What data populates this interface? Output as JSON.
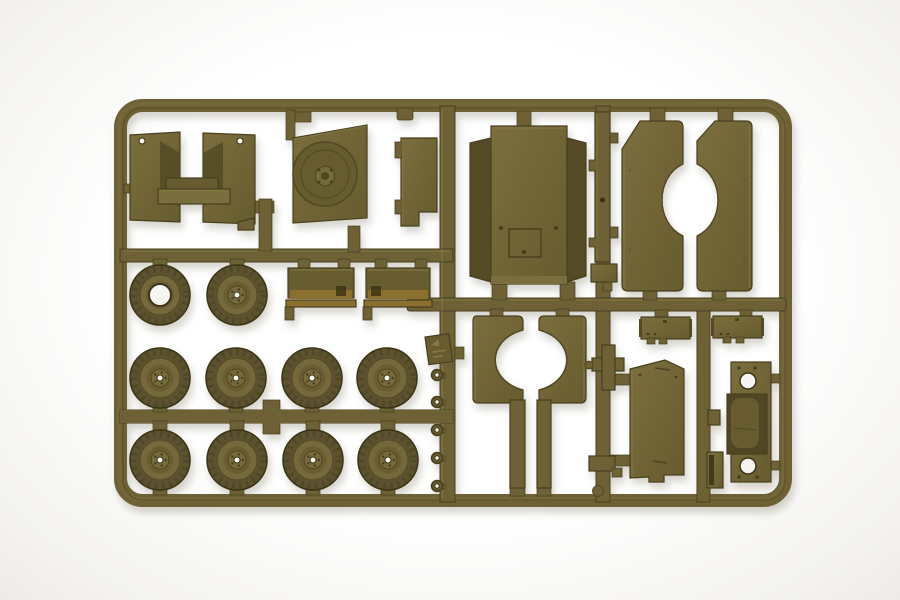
{
  "meta": {
    "type": "photograph",
    "subject": "olive drab injection-molded plastic model kit sprue (parts tree) for a military vehicle kit",
    "background": "plain white studio background with soft shadow"
  },
  "colors": {
    "background": "#f4f3f0",
    "background_center": "#ffffff",
    "plastic_base": "#6d6135",
    "plastic_mid": "#675c2f",
    "plastic_light": "#7b6e3e",
    "plastic_lighter": "#8d7f4a",
    "plastic_dark": "#544a25",
    "plastic_edge": "#473f1e",
    "plastic_deep": "#3a3314",
    "plastic_warm": "#8a6f2e",
    "plastic_recess": "#4f4723",
    "tire": "#5c5230",
    "sidewall": "#75683a",
    "hole_white": "#f6f5f1"
  },
  "sprue": {
    "frame": "rounded rectangular outer frame with internal runners, one center vertical runner and two right vertical runners",
    "parts_inventory": [
      {
        "name": "windshield-frame-bracket",
        "count": 1,
        "location": "top-left"
      },
      {
        "name": "cab-panel-with-round-hatch-disc",
        "count": 1,
        "location": "top-center-left"
      },
      {
        "name": "small-angle-plate",
        "count": 1,
        "location": "top-center beside main runner"
      },
      {
        "name": "cargo-bed-floor-panel",
        "count": 1,
        "location": "top-center"
      },
      {
        "name": "thin-chassis-rail",
        "count": 1,
        "location": "top of right-center runner"
      },
      {
        "name": "fender-panel-half",
        "count": 2,
        "location": "top-right mirrored pair forming circular wheel-arch cutout"
      },
      {
        "name": "road-wheel",
        "count": 10,
        "location": "left block, rows of 2 + 4 + 4",
        "note": "one wheel molded with open hub"
      },
      {
        "name": "stowage-box-strip",
        "count": 2,
        "location": "center-left above wheel rows"
      },
      {
        "name": "mudguard-half-with-stem",
        "count": 2,
        "location": "center mirrored pair forming circular cutout"
      },
      {
        "name": "towing-eyelet-ring",
        "count": 5,
        "location": "left side of center runner"
      },
      {
        "name": "molded-part-tag",
        "count": 1,
        "location": "center runner"
      },
      {
        "name": "stowage-box",
        "count": 3,
        "location": "right-center runners"
      },
      {
        "name": "hood-panel",
        "count": 1,
        "location": "bottom-right"
      },
      {
        "name": "seat-bulkhead-with-two-holes",
        "count": 1,
        "location": "far right"
      },
      {
        "name": "small-bracket",
        "count": 4,
        "location": "scattered on runners"
      }
    ]
  }
}
